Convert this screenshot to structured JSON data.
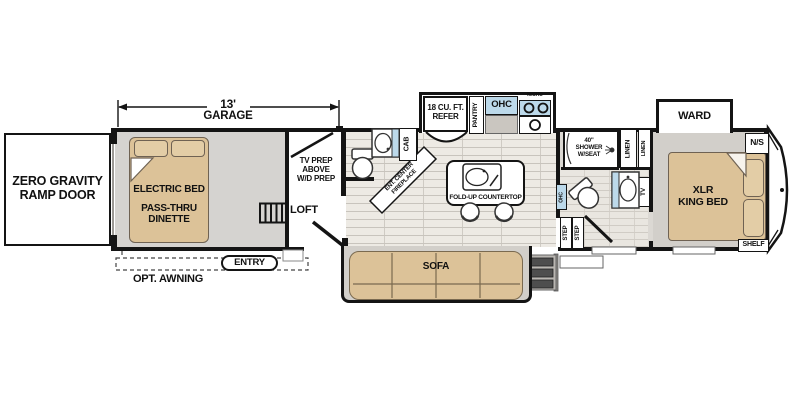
{
  "dimension": {
    "value": "13'",
    "label": "GARAGE"
  },
  "ramp": {
    "label": "ZERO GRAVITY\nRAMP DOOR"
  },
  "garage": {
    "electric_bed": "ELECTRIC BED",
    "dinette": "PASS-THRU\nDINETTE"
  },
  "loft": {
    "tv_prep": "TV PREP\nABOVE\nW/D PREP",
    "loft": "LOFT"
  },
  "exterior": {
    "awning": "OPT. AWNING",
    "entry": "ENTRY"
  },
  "half_bath": {
    "cab": "CAB"
  },
  "fireplace": {
    "label": "ENT. CENTER\nFIREPLACE"
  },
  "kitchen": {
    "refer": "18 CU. FT.\nREFER",
    "pantry": "PANTRY",
    "ohc": "OHC",
    "micro": "MICRO",
    "countertop": "FOLD-UP COUNTERTOP"
  },
  "living": {
    "sofa": "SOFA"
  },
  "stairs": {
    "step_1": "STEP",
    "step_2": "STEP"
  },
  "bath": {
    "shower": "40\"\nSHOWER\nW/SEAT",
    "linen_1": "LINEN",
    "linen_2": "LINEN",
    "ohc": "OHC",
    "tv": "TV"
  },
  "bedroom": {
    "ward": "WARD",
    "nightstand": "N/S",
    "bed": "XLR\nKING BED",
    "shelf": "SHELF"
  },
  "colors": {
    "furniture_tan": "#dcc298",
    "cabinet_blue": "#bcd9ea",
    "wall_black": "#141414",
    "garage_gray": "#d5d3d0",
    "plank_floor": "#edeae4",
    "step_dark": "#4e4e4e"
  }
}
